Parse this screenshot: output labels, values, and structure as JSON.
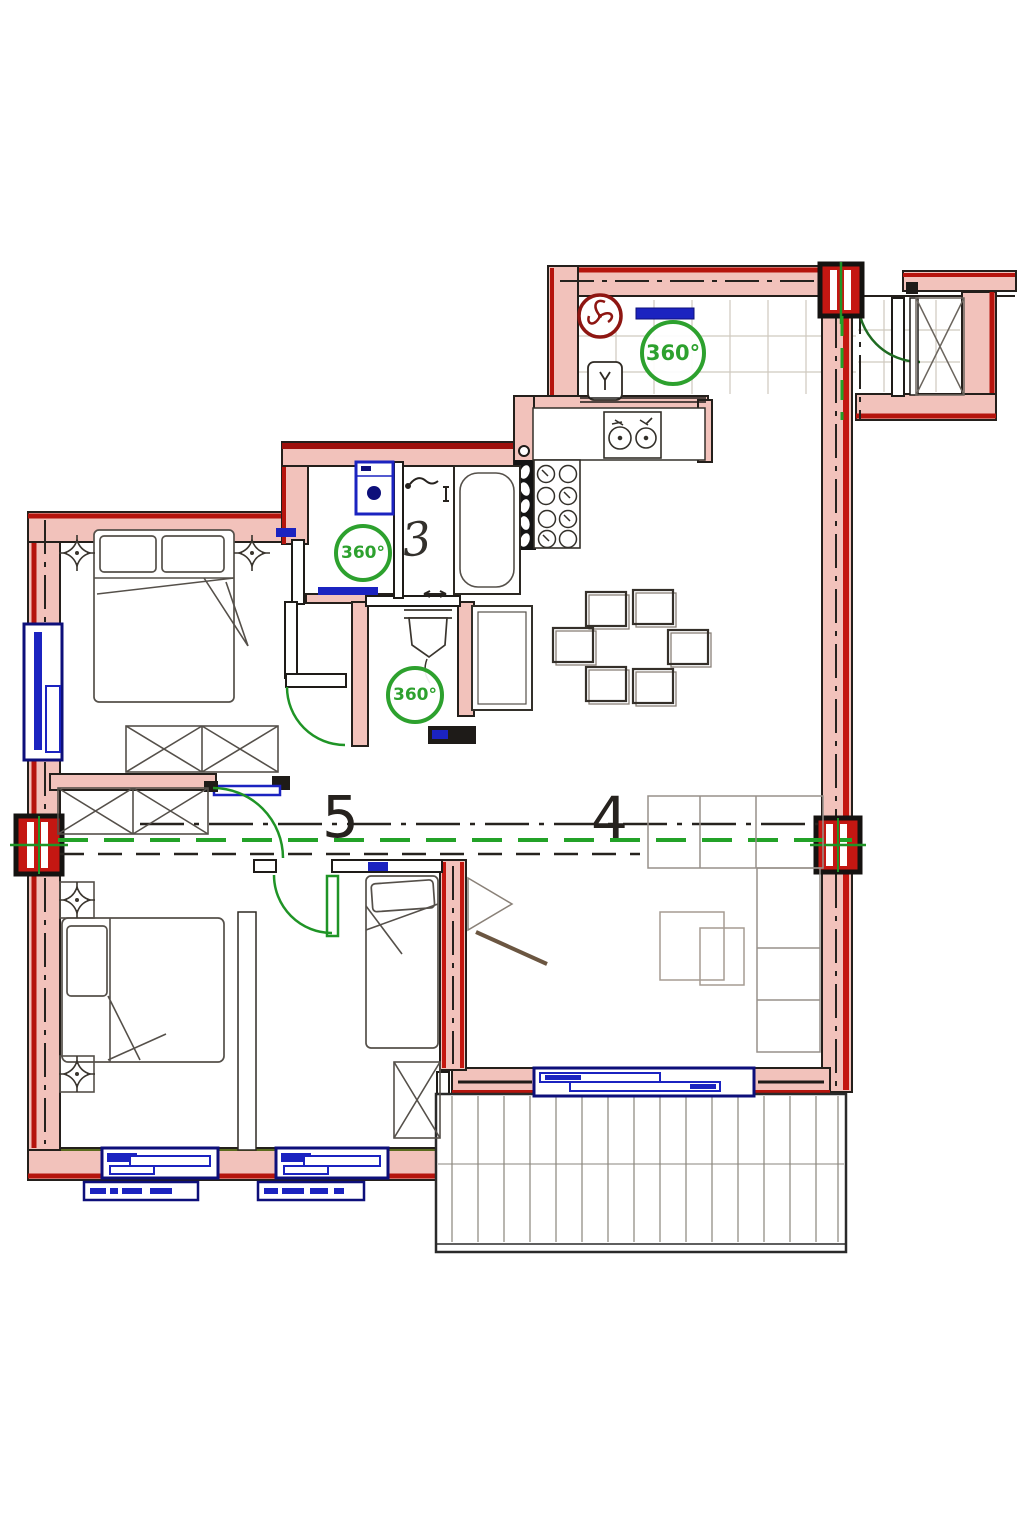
{
  "plan": {
    "type": "apartment-floor-plan",
    "badges": [
      {
        "id": "corridor",
        "label": "360°"
      },
      {
        "id": "bathroom",
        "label": "360°"
      },
      {
        "id": "wc",
        "label": "360°"
      }
    ],
    "rooms": {
      "bathroom_number": "3",
      "section_left": "5",
      "section_right": "4"
    },
    "colors": {
      "wall_red": "#b5140d",
      "wall_pink": "#f2c2bb",
      "window_blue": "#1b23c0",
      "accent_green": "#2da12e",
      "hatch_black": "#141414",
      "sketch_gray": "#55504a"
    },
    "icons": [
      "fan-icon",
      "washing-machine-icon",
      "kitchen-sink-icon",
      "stove-icon",
      "bathtub-icon",
      "toilet-icon",
      "fridge-icon",
      "bed-icon",
      "wardrobe-icon",
      "sofa-icon",
      "dining-chair-icon",
      "downlight-icon",
      "door-swing-icon",
      "window-icon",
      "balcony-decking-icon",
      "section-marker-icon"
    ]
  }
}
